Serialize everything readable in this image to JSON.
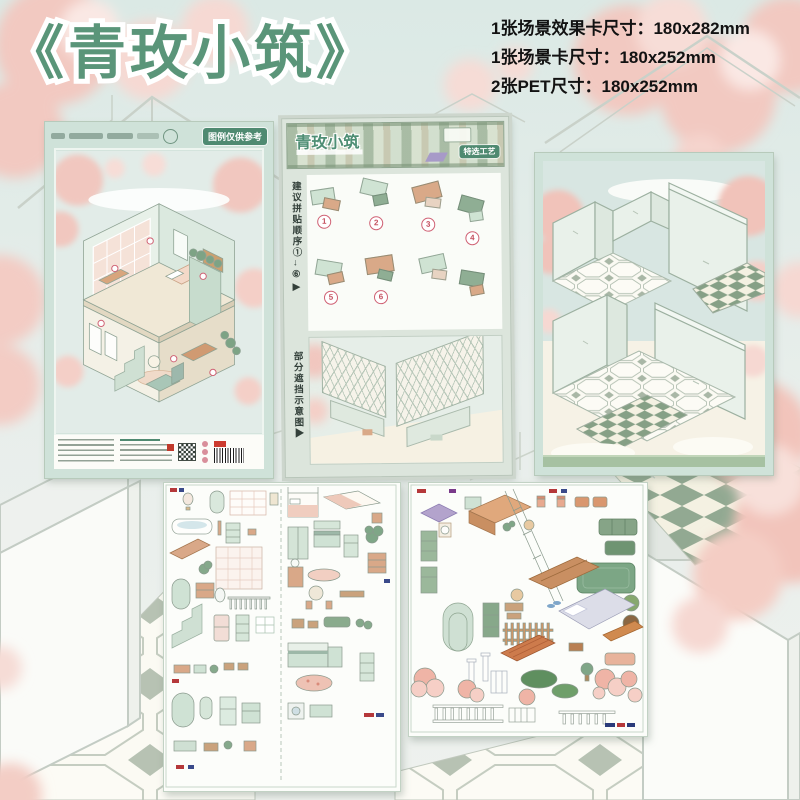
{
  "header": {
    "title": "《青玫小筑》",
    "specs": [
      "1张场景效果卡尺寸：180x282mm",
      "1张场景卡尺寸：180x252mm",
      "2张PET尺寸：180x252mm"
    ]
  },
  "effect_card": {
    "ref_badge": "图例仅供参考"
  },
  "instruction_card": {
    "title": "青玫小筑",
    "craft_badge": "特选工艺",
    "order_note": "建议拼贴顺序①→⑥▶",
    "occlusion_note": "部分遮挡示意图▶",
    "steps": [
      "1",
      "2",
      "3",
      "4",
      "5",
      "6"
    ]
  },
  "colors": {
    "title_green": "#5a9579",
    "badge_green": "#4f8a71",
    "mint_frame": "#cfe2d9"
  }
}
